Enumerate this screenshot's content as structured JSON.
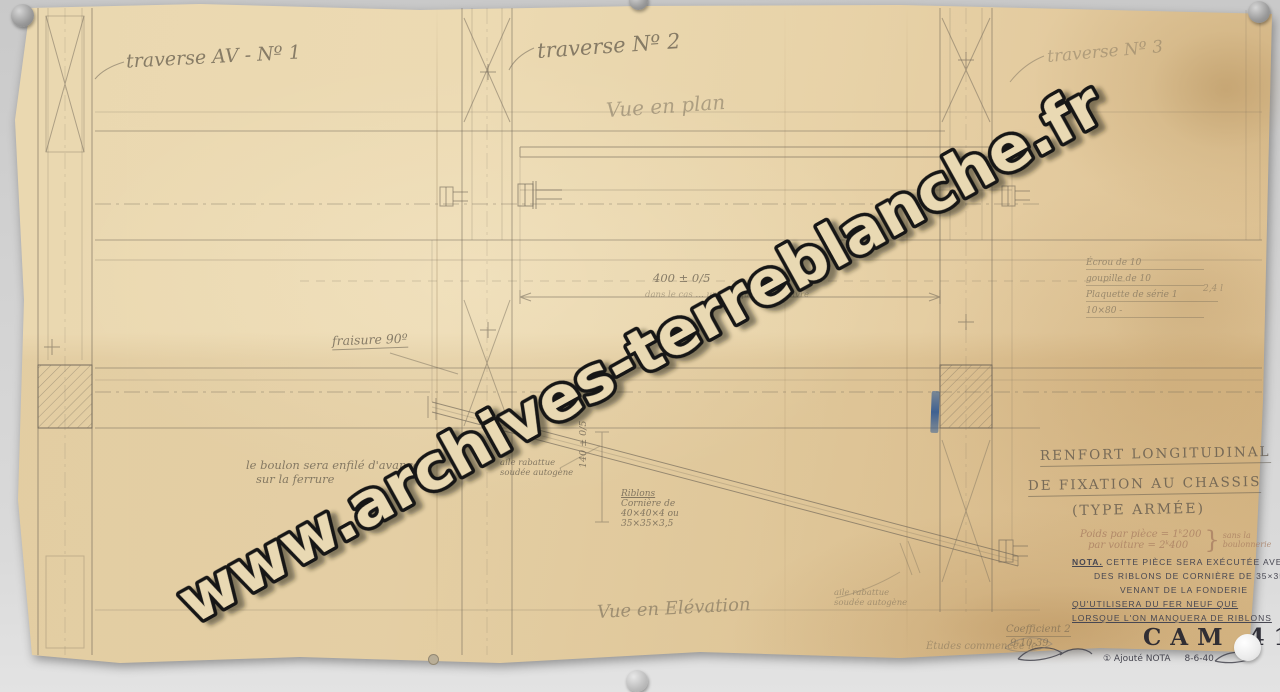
{
  "scan": {
    "watermark_text": "www.archives-terreblanche.fr"
  },
  "plan": {
    "traverse1_label": "traverse AV - Nº 1",
    "traverse2_label": "traverse Nº 2",
    "traverse3_label": "traverse Nº 3",
    "view_title": "Vue en plan",
    "dim_400": "400 ± 0/5",
    "note_plaquette": "dans le cas … une plaquette de cuivre"
  },
  "elevation": {
    "view_title": "Vue en Elévation",
    "fraisure_note": "fraisure 90º",
    "bolt_note_line1": "le boulon sera enfilé d'avance",
    "bolt_note_line2": "sur la ferrure",
    "weld_note_line1": "aile rabattue",
    "weld_note_line2": "soudée autogène",
    "riblons_note_line1": "Riblons",
    "riblons_note_line2": "Cornière de",
    "riblons_note_line3": "40×40×4 ou",
    "riblons_note_line4": "35×35×3,5",
    "dim_140": "140 ± 0/5"
  },
  "parts_list": {
    "rows": [
      "Écrou de 10",
      "goupille de 10",
      "Plaquette de série 1",
      "10×80 -"
    ],
    "qty": "2,4 l"
  },
  "title_block": {
    "title_line1": "RENFORT LONGITUDINAL",
    "title_line2": "DE FIXATION AU CHASSIS",
    "title_line3": "(TYPE ARMÉE)",
    "weight_line1": "Poids par pièce = 1ᵏ200",
    "weight_line2": "par voiture = 2ᵏ400",
    "weight_brace": "}",
    "weight_note_line1": "sans la",
    "weight_note_line2": "boulonnerie",
    "nota_label": "NOTA.",
    "nota_line1": "CETTE PIÈCE SERA EXÉCUTÉE AVEC",
    "nota_line2": "DES RIBLONS DE CORNIÈRE DE 35×35",
    "nota_line3": "VENANT DE LA FONDERIE",
    "nota_line4": "QU'UTILISERA DU FER NEUF QUE",
    "nota_line5": "LORSQUE L'ON MANQUERA DE RIBLONS",
    "drawing_number": "CAM 41",
    "revision_note": "① Ajouté NOTA",
    "revision_date": "8-6-40"
  },
  "footer": {
    "study_note": "Études commencée le",
    "coefficient": "Coefficient 2",
    "date": "9-10-39"
  }
}
